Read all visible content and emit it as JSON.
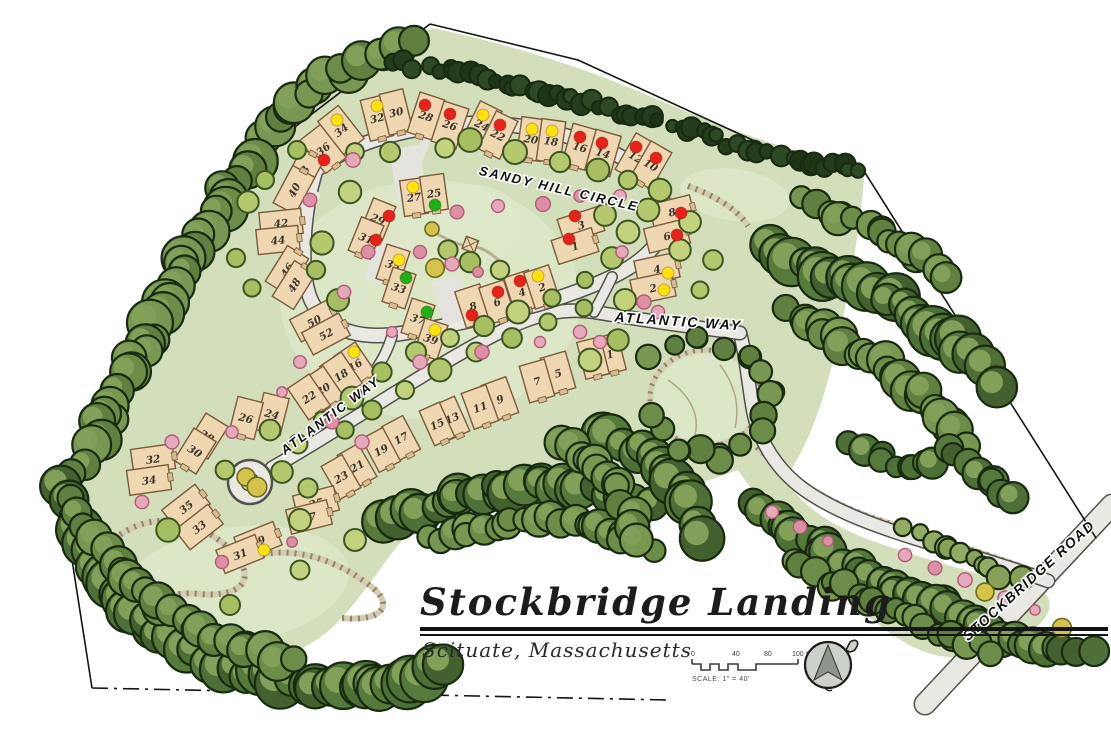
{
  "title_block": {
    "title": "Stockbridge Landing",
    "subtitle": "Scituate, Massachusetts",
    "scale_bar": {
      "ticks": [
        "0",
        "40",
        "80",
        "100"
      ],
      "unit": "feet",
      "caption": "SCALE: 1\" = 40'"
    },
    "north_arrow": "compass-north-arrow"
  },
  "streets": [
    {
      "name": "SANDY HILL CIRCLE",
      "x": 558,
      "y": 193,
      "rotation": 13,
      "size": 13,
      "ls": 2
    },
    {
      "name": "ATLANTIC WAY",
      "x": 678,
      "y": 326,
      "rotation": 4,
      "size": 14,
      "ls": 2
    },
    {
      "name": "ATLANTIC WAY",
      "x": 333,
      "y": 419,
      "rotation": -37,
      "size": 13,
      "ls": 2
    },
    {
      "name": "STOCKBRIDGE ROAD",
      "x": 1032,
      "y": 584,
      "rotation": -42,
      "size": 14,
      "ls": 1.5
    }
  ],
  "status_colors": {
    "red": "#e82119",
    "yellow": "#ffe10d",
    "green": "#1db214"
  },
  "lots": [
    {
      "n": "36",
      "x": 323,
      "y": 149,
      "r": -38,
      "w": 26,
      "h": 42,
      "dot": "red",
      "dx": 324,
      "dy": 160
    },
    {
      "n": "34",
      "x": 341,
      "y": 130,
      "r": -38,
      "w": 26,
      "h": 42,
      "dot": "yellow",
      "dx": 337,
      "dy": 120
    },
    {
      "n": "32",
      "x": 377,
      "y": 118,
      "r": -14,
      "w": 24,
      "h": 42,
      "dot": "yellow",
      "dx": 377,
      "dy": 106
    },
    {
      "n": "30",
      "x": 396,
      "y": 112,
      "r": -14,
      "w": 24,
      "h": 42,
      "dot": null
    },
    {
      "n": "28",
      "x": 426,
      "y": 116,
      "r": 18,
      "w": 26,
      "h": 42,
      "dot": "red",
      "dx": 425,
      "dy": 105
    },
    {
      "n": "26",
      "x": 450,
      "y": 125,
      "r": 18,
      "w": 26,
      "h": 42,
      "dot": "red",
      "dx": 450,
      "dy": 114
    },
    {
      "n": "24",
      "x": 482,
      "y": 125,
      "r": 26,
      "w": 24,
      "h": 42,
      "dot": "yellow",
      "dx": 483,
      "dy": 115
    },
    {
      "n": "22",
      "x": 498,
      "y": 135,
      "r": 26,
      "w": 24,
      "h": 42,
      "dot": "red",
      "dx": 500,
      "dy": 125
    },
    {
      "n": "20",
      "x": 531,
      "y": 139,
      "r": 8,
      "w": 24,
      "h": 42,
      "dot": "yellow",
      "dx": 532,
      "dy": 129
    },
    {
      "n": "18",
      "x": 551,
      "y": 141,
      "r": 8,
      "w": 24,
      "h": 42,
      "dot": "yellow",
      "dx": 552,
      "dy": 131
    },
    {
      "n": "16",
      "x": 580,
      "y": 147,
      "r": 16,
      "w": 26,
      "h": 42,
      "dot": "red",
      "dx": 580,
      "dy": 137
    },
    {
      "n": "14",
      "x": 603,
      "y": 153,
      "r": 16,
      "w": 26,
      "h": 42,
      "dot": "red",
      "dx": 602,
      "dy": 143
    },
    {
      "n": "12",
      "x": 636,
      "y": 157,
      "r": 30,
      "w": 24,
      "h": 42,
      "dot": "red",
      "dx": 636,
      "dy": 147
    },
    {
      "n": "10",
      "x": 651,
      "y": 165,
      "r": 30,
      "w": 24,
      "h": 42,
      "dot": "red",
      "dx": 656,
      "dy": 158
    },
    {
      "n": "8",
      "x": 672,
      "y": 212,
      "r": -14,
      "w": 42,
      "h": 25,
      "dot": "red",
      "dx": 681,
      "dy": 213
    },
    {
      "n": "6",
      "x": 667,
      "y": 236,
      "r": -14,
      "w": 42,
      "h": 25,
      "dot": "red",
      "dx": 677,
      "dy": 235
    },
    {
      "n": "4",
      "x": 657,
      "y": 269,
      "r": -12,
      "w": 42,
      "h": 25,
      "dot": "yellow",
      "dx": 668,
      "dy": 273
    },
    {
      "n": "2",
      "x": 653,
      "y": 288,
      "r": -12,
      "w": 42,
      "h": 25,
      "dot": "yellow",
      "dx": 664,
      "dy": 290
    },
    {
      "n": "3",
      "x": 581,
      "y": 225,
      "r": -18,
      "w": 42,
      "h": 25,
      "dot": "red",
      "dx": 575,
      "dy": 216
    },
    {
      "n": "1",
      "x": 575,
      "y": 246,
      "r": -18,
      "w": 42,
      "h": 25,
      "dot": "red",
      "dx": 569,
      "dy": 239
    },
    {
      "n": "38",
      "x": 303,
      "y": 173,
      "r": -62,
      "w": 42,
      "h": 25,
      "dot": null
    },
    {
      "n": "40",
      "x": 294,
      "y": 190,
      "r": -62,
      "w": 42,
      "h": 25,
      "dot": null
    },
    {
      "n": "42",
      "x": 281,
      "y": 223,
      "r": -6,
      "w": 42,
      "h": 25,
      "dot": null
    },
    {
      "n": "44",
      "x": 278,
      "y": 240,
      "r": -6,
      "w": 42,
      "h": 25,
      "dot": null
    },
    {
      "n": "46",
      "x": 287,
      "y": 270,
      "r": -58,
      "w": 42,
      "h": 25,
      "dot": null
    },
    {
      "n": "48",
      "x": 294,
      "y": 285,
      "r": -58,
      "w": 42,
      "h": 25,
      "dot": null
    },
    {
      "n": "50",
      "x": 314,
      "y": 321,
      "r": -28,
      "w": 42,
      "h": 25,
      "dot": null
    },
    {
      "n": "52",
      "x": 326,
      "y": 334,
      "r": -28,
      "w": 42,
      "h": 25,
      "dot": null
    },
    {
      "n": "27",
      "x": 414,
      "y": 197,
      "r": -8,
      "w": 24,
      "h": 36,
      "dot": "yellow",
      "dx": 413,
      "dy": 187
    },
    {
      "n": "25",
      "x": 434,
      "y": 193,
      "r": -8,
      "w": 24,
      "h": 36,
      "dot": "green",
      "dx": 435,
      "dy": 205
    },
    {
      "n": "29",
      "x": 378,
      "y": 219,
      "r": 22,
      "w": 24,
      "h": 36,
      "dot": "red",
      "dx": 389,
      "dy": 216
    },
    {
      "n": "31",
      "x": 366,
      "y": 238,
      "r": 22,
      "w": 24,
      "h": 36,
      "dot": "red",
      "dx": 376,
      "dy": 240
    },
    {
      "n": "35",
      "x": 393,
      "y": 265,
      "r": 18,
      "w": 24,
      "h": 36,
      "dot": "yellow",
      "dx": 399,
      "dy": 260
    },
    {
      "n": "33",
      "x": 399,
      "y": 288,
      "r": 18,
      "w": 24,
      "h": 36,
      "dot": "green",
      "dx": 406,
      "dy": 278
    },
    {
      "n": "37",
      "x": 418,
      "y": 319,
      "r": 18,
      "w": 24,
      "h": 36,
      "dot": "green",
      "dx": 427,
      "dy": 312
    },
    {
      "n": "39",
      "x": 431,
      "y": 339,
      "r": 18,
      "w": 24,
      "h": 36,
      "dot": "yellow",
      "dx": 435,
      "dy": 330
    },
    {
      "n": "8",
      "x": 473,
      "y": 306,
      "r": -18,
      "w": 26,
      "h": 38,
      "dot": "red",
      "dx": 472,
      "dy": 315
    },
    {
      "n": "6",
      "x": 497,
      "y": 302,
      "r": -18,
      "w": 26,
      "h": 38,
      "dot": "red",
      "dx": 498,
      "dy": 292
    },
    {
      "n": "4",
      "x": 522,
      "y": 292,
      "r": -18,
      "w": 26,
      "h": 38,
      "dot": "red",
      "dx": 520,
      "dy": 281
    },
    {
      "n": "2",
      "x": 542,
      "y": 287,
      "r": -18,
      "w": 26,
      "h": 38,
      "dot": "yellow",
      "dx": 538,
      "dy": 276
    },
    {
      "n": "16",
      "x": 355,
      "y": 365,
      "r": -34,
      "w": 26,
      "h": 38,
      "dot": "yellow",
      "dx": 354,
      "dy": 352
    },
    {
      "n": "18",
      "x": 341,
      "y": 375,
      "r": -34,
      "w": 26,
      "h": 38,
      "dot": null
    },
    {
      "n": "20",
      "x": 323,
      "y": 389,
      "r": -34,
      "w": 26,
      "h": 38,
      "dot": null
    },
    {
      "n": "22",
      "x": 309,
      "y": 397,
      "r": -34,
      "w": 26,
      "h": 38,
      "dot": null
    },
    {
      "n": "1",
      "x": 610,
      "y": 354,
      "r": -14,
      "w": 24,
      "h": 38,
      "dot": null
    },
    {
      "n": "3",
      "x": 593,
      "y": 358,
      "r": -14,
      "w": 24,
      "h": 38,
      "dot": null
    },
    {
      "n": "5",
      "x": 558,
      "y": 373,
      "r": -16,
      "w": 26,
      "h": 38,
      "dot": null
    },
    {
      "n": "7",
      "x": 537,
      "y": 381,
      "r": -16,
      "w": 26,
      "h": 38,
      "dot": null
    },
    {
      "n": "9",
      "x": 500,
      "y": 399,
      "r": -20,
      "w": 26,
      "h": 38,
      "dot": null
    },
    {
      "n": "11",
      "x": 480,
      "y": 407,
      "r": -20,
      "w": 26,
      "h": 38,
      "dot": null
    },
    {
      "n": "13",
      "x": 452,
      "y": 418,
      "r": -24,
      "w": 22,
      "h": 38,
      "dot": null
    },
    {
      "n": "15",
      "x": 437,
      "y": 424,
      "r": -24,
      "w": 22,
      "h": 38,
      "dot": null
    },
    {
      "n": "17",
      "x": 401,
      "y": 438,
      "r": -28,
      "w": 24,
      "h": 38,
      "dot": null
    },
    {
      "n": "19",
      "x": 381,
      "y": 450,
      "r": -28,
      "w": 24,
      "h": 38,
      "dot": null
    },
    {
      "n": "21",
      "x": 357,
      "y": 466,
      "r": -30,
      "w": 24,
      "h": 38,
      "dot": null
    },
    {
      "n": "23",
      "x": 341,
      "y": 477,
      "r": -30,
      "w": 24,
      "h": 38,
      "dot": null
    },
    {
      "n": "25",
      "x": 316,
      "y": 503,
      "r": -14,
      "w": 42,
      "h": 25,
      "dot": null
    },
    {
      "n": "27",
      "x": 309,
      "y": 517,
      "r": -14,
      "w": 42,
      "h": 25,
      "dot": null
    },
    {
      "n": "24",
      "x": 272,
      "y": 414,
      "r": 14,
      "w": 26,
      "h": 38,
      "dot": null
    },
    {
      "n": "26",
      "x": 246,
      "y": 418,
      "r": 14,
      "w": 26,
      "h": 38,
      "dot": null
    },
    {
      "n": "28",
      "x": 207,
      "y": 436,
      "r": 32,
      "w": 26,
      "h": 38,
      "dot": null
    },
    {
      "n": "30",
      "x": 195,
      "y": 451,
      "r": 32,
      "w": 26,
      "h": 38,
      "dot": null
    },
    {
      "n": "32",
      "x": 153,
      "y": 459,
      "r": -8,
      "w": 42,
      "h": 25,
      "dot": null
    },
    {
      "n": "34",
      "x": 149,
      "y": 480,
      "r": -8,
      "w": 42,
      "h": 25,
      "dot": null
    },
    {
      "n": "35",
      "x": 186,
      "y": 507,
      "r": -38,
      "w": 42,
      "h": 25,
      "dot": null
    },
    {
      "n": "33",
      "x": 199,
      "y": 527,
      "r": -38,
      "w": 42,
      "h": 25,
      "dot": null
    },
    {
      "n": "29",
      "x": 258,
      "y": 541,
      "r": -22,
      "w": 42,
      "h": 25,
      "dot": "yellow",
      "dx": 264,
      "dy": 550
    },
    {
      "n": "31",
      "x": 240,
      "y": 554,
      "r": -22,
      "w": 42,
      "h": 25,
      "dot": null
    }
  ]
}
